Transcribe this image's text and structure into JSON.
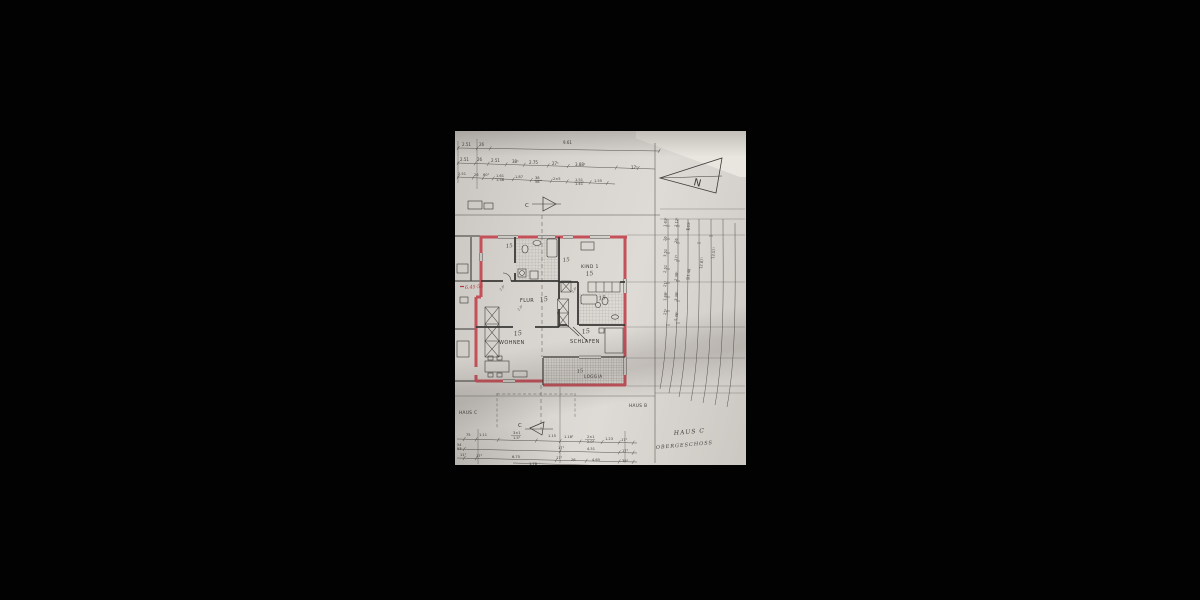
{
  "photo": {
    "background": "#020202",
    "paper_color": "#d7d3ce",
    "wall_color": "#e8e6df"
  },
  "colors": {
    "ink": "#3b3a37",
    "red_wall": "#c4505a",
    "red_text": "#b23a40",
    "pencil": "#4e4b45"
  },
  "north_arrow": {
    "label": "N"
  },
  "section": {
    "marker_top": "C",
    "marker_bottom": "C"
  },
  "title_block": {
    "haus_left": "HAUS C",
    "haus_right": "HAUS B",
    "haus_title": "HAUS C",
    "floor_title": "OBERGESCHOSS"
  },
  "rooms": [
    {
      "label": "KIND 1",
      "mark": "15"
    },
    {
      "label": "FLUR",
      "mark": "15"
    },
    {
      "label": "WOHNEN",
      "mark": "15"
    },
    {
      "label": "SCHLAFEN",
      "mark": "15"
    },
    {
      "label": "LOGGIA",
      "mark": "15"
    }
  ],
  "annotations": {
    "red_note": "6.45·55",
    "room_marks": [
      "15",
      "15",
      "15"
    ],
    "door_marks": [
      "2.0¹",
      "2.0¹",
      "2.0¹"
    ]
  },
  "dim_top": {
    "row1": [
      "2.51",
      "26",
      "9.61"
    ],
    "row2": [
      "2.51",
      "26",
      "2.51",
      "38¹",
      "2.75",
      "27¹",
      "3.88¹",
      "17¹"
    ],
    "row3": [
      "2.51",
      "26",
      "60¹",
      "1.61",
      "1.38",
      "1.87",
      "38",
      "58",
      "2×5",
      "1.51",
      "1.41",
      "1.55"
    ]
  },
  "dim_bottom": {
    "row1": [
      "75",
      "1.11",
      "3×1",
      "1.5¹",
      "1.15",
      "1.18¹",
      "2×1",
      "2.0¹",
      "1.23",
      "17¹"
    ],
    "row2": [
      "54",
      "53",
      "17¹",
      "4.51",
      "17¹"
    ],
    "row3": [
      "11¹",
      "17¹",
      "6.75",
      "17¹",
      "26",
      "4.65",
      "39¹",
      "1.78"
    ]
  },
  "dim_right": {
    "col1": [
      "1.63¹",
      "26",
      "3.51",
      "2.51",
      "21¹",
      "1.68¹",
      "25¹"
    ],
    "col2": [
      "2.12¹",
      "26",
      "17¹",
      "2.38¹",
      "3.38¹",
      "5.36¹"
    ],
    "col3": [
      "1.63¹",
      "11.48"
    ],
    "col4": [
      "12.87¹"
    ],
    "col5": [
      "13.57¹"
    ]
  }
}
